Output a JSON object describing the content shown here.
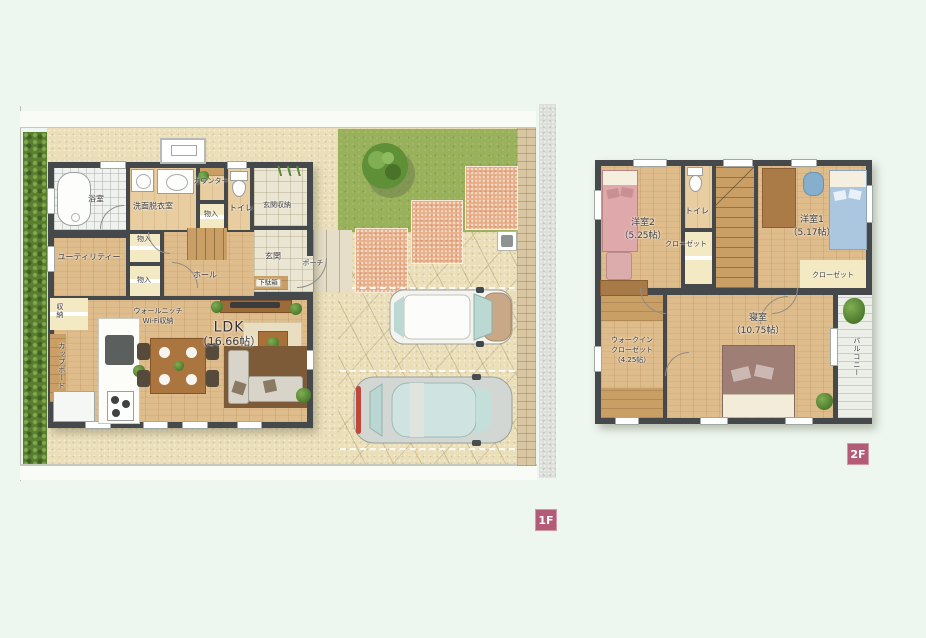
{
  "colors": {
    "background": "#edf6ef",
    "wall": "#45494c",
    "wood_floor": "#dfbc8b",
    "closet_floor": "#f3e9c3",
    "lawn": "#99b15a",
    "hedge": "#587e30",
    "terracotta_paver": "#e9b28d",
    "driveway": "#ebdfba",
    "badge": "#b45c77"
  },
  "badges": {
    "f1": "1F",
    "f2": "2F"
  },
  "f1": {
    "bath": "浴室",
    "washroom": "洗面脱衣室",
    "counter": "カウンター",
    "toilet": "トイレ",
    "entrance_storage": "玄関収納",
    "storage": "物入",
    "utility": "ユーティリティー",
    "hall": "ホール",
    "entrance": "玄関",
    "porch": "ポーチ",
    "shoe_cabinet": "下駄箱",
    "closet": "収納",
    "cupboard": "カップボード",
    "wall_niche": "ウォールニッチ",
    "wifi_storage": "Wi-Fi収納",
    "ldk": "LDK",
    "ldk_size": "（16.66帖）"
  },
  "f2": {
    "bedroom2": "洋室2",
    "bedroom2_size": "（5.25帖）",
    "toilet": "トイレ",
    "closet_a": "クローゼット",
    "bedroom1": "洋室1",
    "bedroom1_size": "（5.17帖）",
    "closet_b": "クローゼット",
    "wic_line1": "ウォークイン",
    "wic_line2": "クローゼット",
    "wic_size": "（4.25帖）",
    "master": "寝室",
    "master_size": "（10.75帖）",
    "balcony": "バルコニー"
  }
}
